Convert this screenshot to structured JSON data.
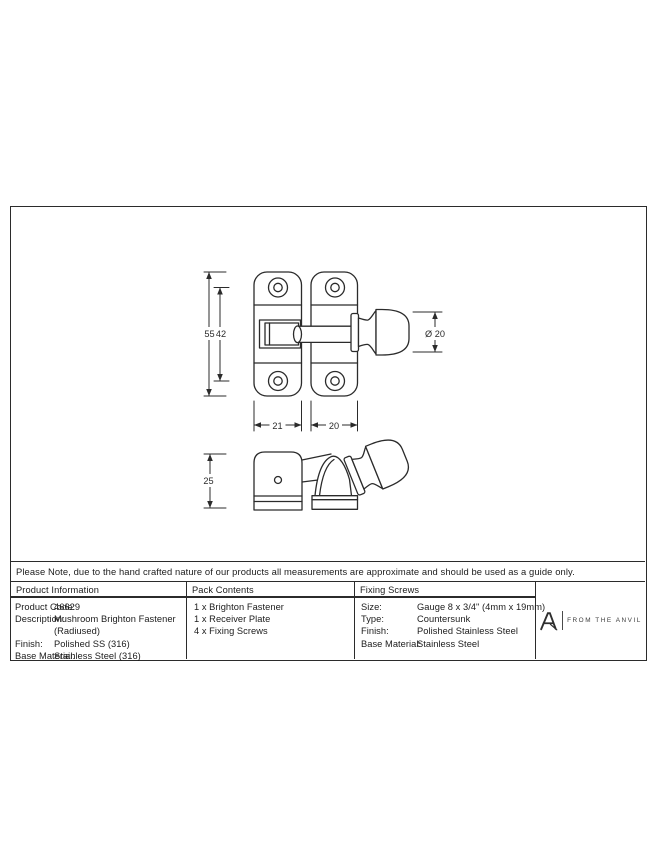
{
  "note": "Please Note, due to the hand crafted nature of our products all measurements are approximate and should be used as a guide only.",
  "table": {
    "product_information": {
      "header": "Product Information",
      "rows": [
        {
          "label": "Product Code:",
          "value": "46629"
        },
        {
          "label": "Description:",
          "value": "Mushroom Brighton Fastener"
        },
        {
          "label": "",
          "value": "(Radiused)"
        },
        {
          "label": "Finish:",
          "value": "Polished SS (316)"
        },
        {
          "label": "Base Material:",
          "value": "Stainless Steel (316)"
        }
      ]
    },
    "pack_contents": {
      "header": "Pack Contents",
      "items": [
        "1 x Brighton Fastener",
        "1 x Receiver Plate",
        "4 x Fixing Screws"
      ]
    },
    "fixing_screws": {
      "header": "Fixing Screws",
      "rows": [
        {
          "label": "Size:",
          "value": "Gauge 8 x 3/4\" (4mm x 19mm)"
        },
        {
          "label": "Type:",
          "value": "Countersunk"
        },
        {
          "label": "Finish:",
          "value": "Polished Stainless Steel"
        },
        {
          "label": "Base Material:",
          "value": "Stainless Steel"
        }
      ]
    },
    "brand": {
      "name": "FROM THE ANVIL"
    }
  },
  "drawing": {
    "front_view_dimensions": {
      "overall_height": "55",
      "screw_hole_spacing": "42",
      "knob_diameter": "Ø 20",
      "backplate_width": "21",
      "receiver_width": "20"
    },
    "side_view_dimensions": {
      "projection_depth": "25"
    },
    "line_color": "#2b2b2b"
  }
}
